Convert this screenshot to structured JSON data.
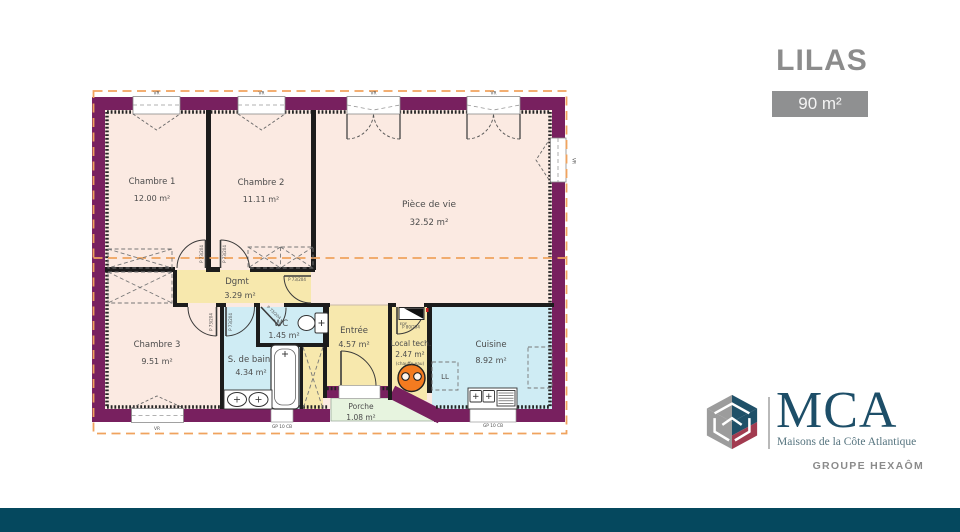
{
  "page": {
    "title": "LILAS",
    "area_badge": "90 m²"
  },
  "plan": {
    "rooms": {
      "chambre1": {
        "name": "Chambre 1",
        "area": "12.00 m²"
      },
      "chambre2": {
        "name": "Chambre 2",
        "area": "11.11 m²"
      },
      "piece_de_vie": {
        "name": "Pièce de vie",
        "area": "32.52 m²"
      },
      "dgmt": {
        "name": "Dgmt",
        "area": "3.29 m²"
      },
      "wc": {
        "name": "WC",
        "area": "1.45 m²"
      },
      "chambre3": {
        "name": "Chambre 3",
        "area": "9.51 m²"
      },
      "sdb": {
        "name": "S. de bain",
        "area": "4.34 m²"
      },
      "entree": {
        "name": "Entrée",
        "area": "4.57 m²"
      },
      "local_tech": {
        "name": "Local tech.",
        "area": "2.47 m²",
        "note": "(chauffe-eau)"
      },
      "cuisine": {
        "name": "Cuisine",
        "area": "8.92 m²"
      },
      "porche": {
        "name": "Porche",
        "area": "1.08 m²"
      }
    },
    "labels": {
      "window_code": "VR",
      "access_panel": "GP 10 CB",
      "door_code": "P 73/204",
      "door_code_large": "P 80/204",
      "washing_machine": "LL",
      "electrical": "EDF"
    }
  },
  "brand": {
    "name": "MCA",
    "tagline": "Maisons de la Côte Atlantique",
    "group": "GROUPE HEXAÔM"
  },
  "colors": {
    "accent_teal": "#05485e",
    "wall_purple": "#78205f",
    "badge_gray": "#8f9091",
    "heater_orange": "#f37b20",
    "room_pink": "#fbeae2",
    "room_yellow": "#f7e8ad",
    "room_blue": "#cfecf4",
    "room_green": "#e7f4df",
    "roof_dash_orange": "#f0a35e"
  }
}
